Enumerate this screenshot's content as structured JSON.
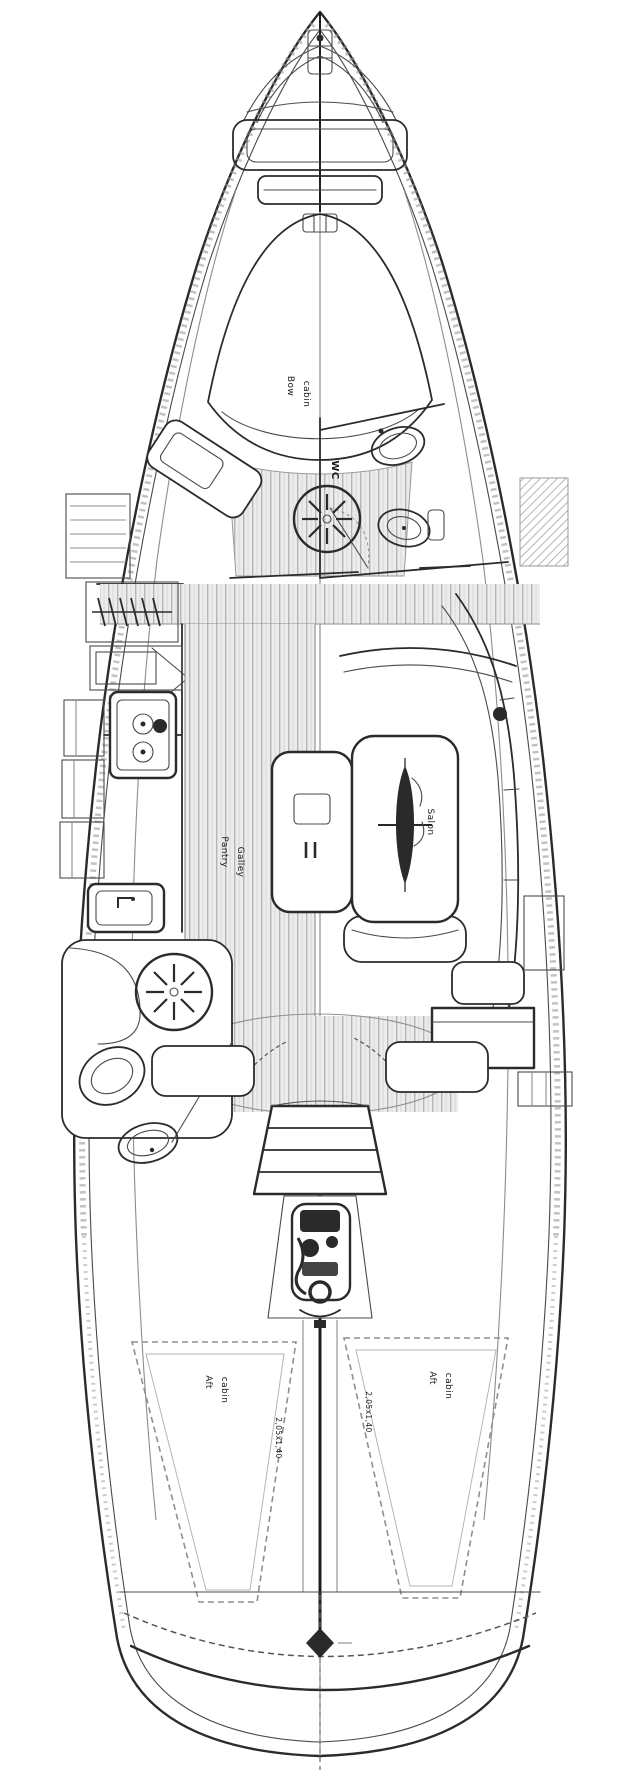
{
  "diagram": {
    "labels": {
      "bow_cabin": {
        "line1": "Bow",
        "line2": "cabin"
      },
      "wc_forward": "WC",
      "galley": {
        "line1": "Pantry",
        "line2": "Galley"
      },
      "salon": "Salon",
      "wc_aft": "WC",
      "aft_cabin_port": {
        "line1": "Aft",
        "line2": "cabin"
      },
      "aft_cabin_starboard": {
        "line1": "Aft",
        "line2": "cabin"
      },
      "berth_dim_port": "2,05x1,40",
      "berth_dim_starboard": "2,05x1,40"
    },
    "colors": {
      "line": "#2b2b2b",
      "soft_line": "#8d8d8d",
      "plank_stripe": "#b5b5b5",
      "floor": "#ececec",
      "background": "#ffffff",
      "label": "#1b1b1b"
    }
  }
}
